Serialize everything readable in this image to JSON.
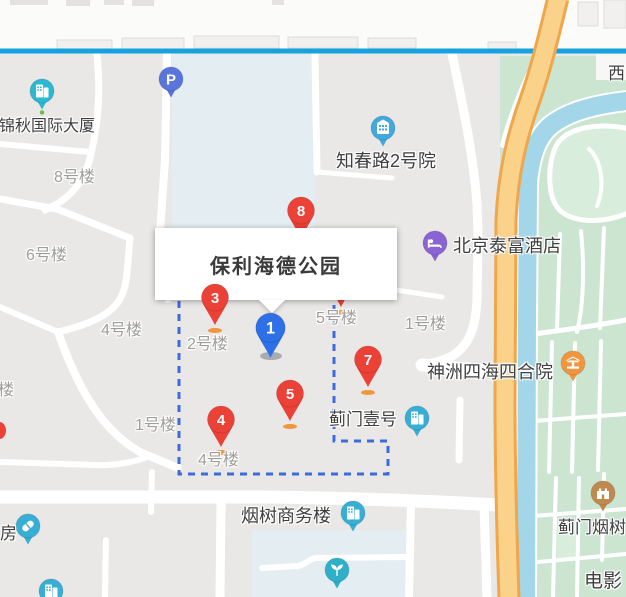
{
  "colors": {
    "park": "#CBE5D1",
    "park_inner": "#D8EDDC",
    "river": "#A3D6E8",
    "highway_fill": "#FBD28A",
    "highway_casing": "#EFA64D",
    "transit_line": "#16A2DD",
    "boundary": "#3D6BDC",
    "block_blue": "#E4EEF2",
    "red_pin": "#EC4137",
    "blue_pin": "#2E70E7",
    "pin_shadow_orange": "#F0963C"
  },
  "info_window": {
    "title": "保利海德公园"
  },
  "numbered_pins": [
    {
      "label": "8"
    },
    {
      "label": ""
    },
    {
      "label": "3"
    },
    {
      "label": "1"
    },
    {
      "label": "7"
    },
    {
      "label": "5"
    },
    {
      "label": "4"
    }
  ],
  "poi_markers": [
    {
      "name": "parking",
      "icon_text": "P",
      "color": "#5974DA"
    },
    {
      "name": "jinqiu-intl-tower",
      "color": "#2BB8D2"
    },
    {
      "name": "zhichun-rd-court-2",
      "color": "#41A9DE"
    },
    {
      "name": "beijing-taifu-hotel",
      "color": "#8A64D3"
    },
    {
      "name": "shenzhou-sihai-siheyuan",
      "color": "#F2953F"
    },
    {
      "name": "jimen-no1",
      "color": "#36AED6"
    },
    {
      "name": "yanshu-business-tower",
      "color": "#36AED6"
    },
    {
      "name": "pharmacy",
      "color": "#36AED6"
    },
    {
      "name": "building-sw",
      "color": "#36AED6"
    },
    {
      "name": "garden",
      "color": "#2FB0C9"
    },
    {
      "name": "jimen-yanshu",
      "color": "#C0894E"
    }
  ],
  "labels": {
    "gray": [
      {
        "text": "8号楼"
      },
      {
        "text": "6号楼"
      },
      {
        "text": "4号楼"
      },
      {
        "text": "2号楼"
      },
      {
        "text": "5号楼"
      },
      {
        "text": "1号楼"
      },
      {
        "text": "1号楼"
      },
      {
        "text": "4号楼"
      },
      {
        "text": "楼"
      }
    ],
    "dark": [
      {
        "text": "锦秋国际大厦"
      },
      {
        "text": "知春路2号院"
      },
      {
        "text": "北京泰富酒店"
      },
      {
        "text": "神洲四海四合院"
      },
      {
        "text": "蓟门壹号"
      },
      {
        "text": "烟树商务楼"
      },
      {
        "text": "蓟门烟树"
      },
      {
        "text": "电影"
      },
      {
        "text": "房"
      },
      {
        "text": "西"
      }
    ]
  }
}
